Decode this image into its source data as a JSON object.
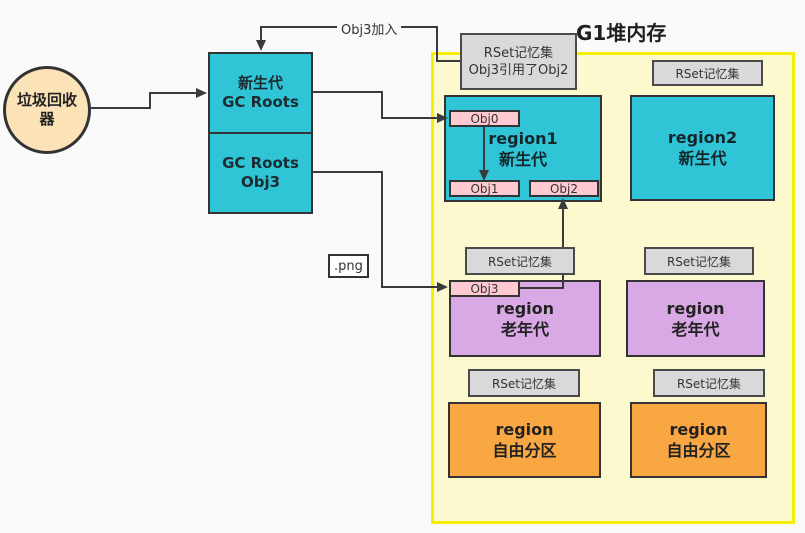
{
  "title": "G1堆内存",
  "collector": {
    "line1": "垃圾回收",
    "line2": "器"
  },
  "gc_box": {
    "top_line1": "新生代",
    "top_line2": "GC Roots",
    "bottom_line1": "GC Roots",
    "bottom_line2": "Obj3"
  },
  "arrows": {
    "obj3_join_label": "Obj3加入"
  },
  "png_label": ".png",
  "heap": {
    "note": {
      "line1": "RSet记忆集",
      "line2": "Obj3引用了Obj2"
    },
    "rset_label": "RSet记忆集",
    "regions": {
      "region1": {
        "line1": "region1",
        "line2": "新生代"
      },
      "region2": {
        "line1": "region2",
        "line2": "新生代"
      },
      "old_left": {
        "line1": "region",
        "line2": "老年代"
      },
      "old_right": {
        "line1": "region",
        "line2": "老年代"
      },
      "free_left": {
        "line1": "region",
        "line2": "自由分区"
      },
      "free_right": {
        "line1": "region",
        "line2": "自由分区"
      }
    },
    "objects": {
      "obj0": "Obj0",
      "obj1": "Obj1",
      "obj2": "Obj2",
      "obj3": "Obj3"
    }
  },
  "colors": {
    "young_region": "#2FC5D7",
    "old_region": "#D9A9E6",
    "free_region": "#F9A743",
    "object_box": "#FFC9D2",
    "rset_box": "#D9D9D9",
    "heap_fill": "#FCF9CE",
    "heap_border": "#F2EF00",
    "collector_fill": "#FBE2B7",
    "connector_line": "#3A3A3A"
  }
}
